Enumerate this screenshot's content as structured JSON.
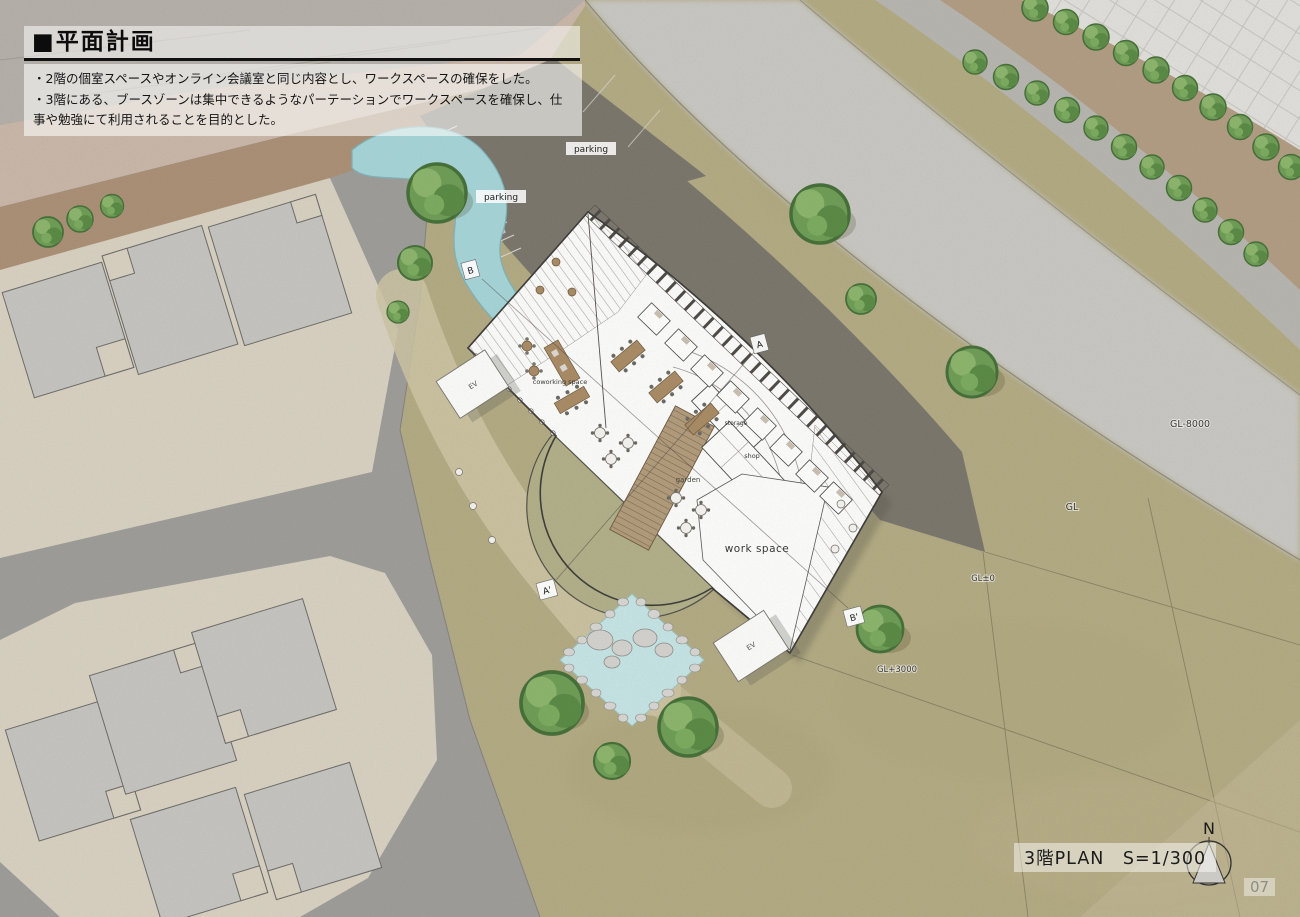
{
  "header": {
    "title": "■平面計画",
    "notes": [
      "・2階の個室スペースやオンライン会議室と同じ内容とし、ワークスペースの確保をした。",
      "・3階にある、ブースゾーンは集中できるようなパーテーションでワークスペースを確保し、仕事や勉強にて利用されることを目的とした。"
    ]
  },
  "plan": {
    "labels": {
      "parking_upper": "parking",
      "parking_lower": "parking",
      "ev_upper": "EV",
      "ev_lower": "EV",
      "coworking": "coworking space",
      "storage": "storage",
      "shop": "shop",
      "garden": "garden",
      "work_space": "work space"
    },
    "levels": {
      "gl_minus8000": "GL-8000",
      "gl": "GL",
      "gl_zero": "GL±0",
      "gl_plus3000": "GL+3000"
    },
    "sections": {
      "a": "A",
      "a_prime": "A'",
      "b": "B",
      "b_prime": "B'"
    }
  },
  "footer": {
    "plan_title": "3階PLAN　S=1/300",
    "north": "N",
    "page": "07"
  },
  "colors": {
    "grass": "#b3ab84",
    "river": "#c8c7c3",
    "lot": "#d8d1c2",
    "house": "#c5c4c1",
    "road_gray": "#9e9d99",
    "road_pink": "#cab7a9",
    "road_brown": "#aa9074",
    "parking_gravel": "#7b776d",
    "pond": "#a6d4d8",
    "building": "#fbfbfa",
    "garden_green": "#b1b08a",
    "stair_brown": "#b29c7c",
    "tree_green": "#6f9d57"
  }
}
